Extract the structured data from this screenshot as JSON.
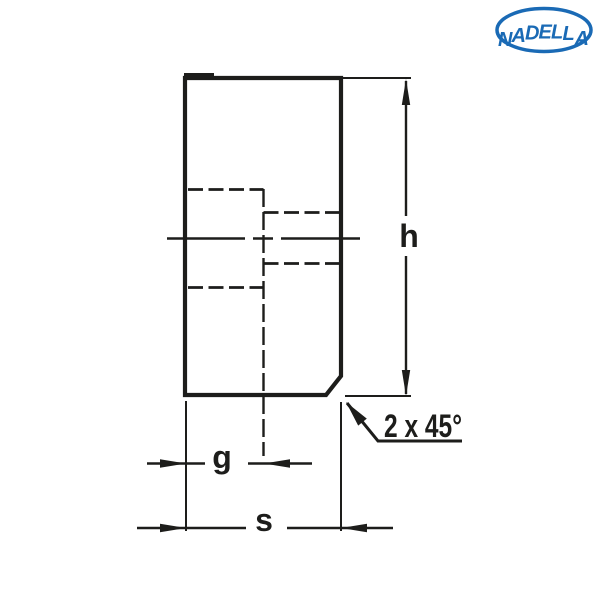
{
  "page": {
    "background_color": "#ffffff"
  },
  "logo": {
    "text": "NADELLA",
    "color": "#1a6ab5"
  },
  "drawing": {
    "line_color": "#1d1d1b",
    "type": "section view of cylindrical threaded bushing with stepped bore and chamfer",
    "labels": {
      "height": "h",
      "bore": "g",
      "width": "s",
      "chamfer_note": "2 x 45°"
    }
  }
}
